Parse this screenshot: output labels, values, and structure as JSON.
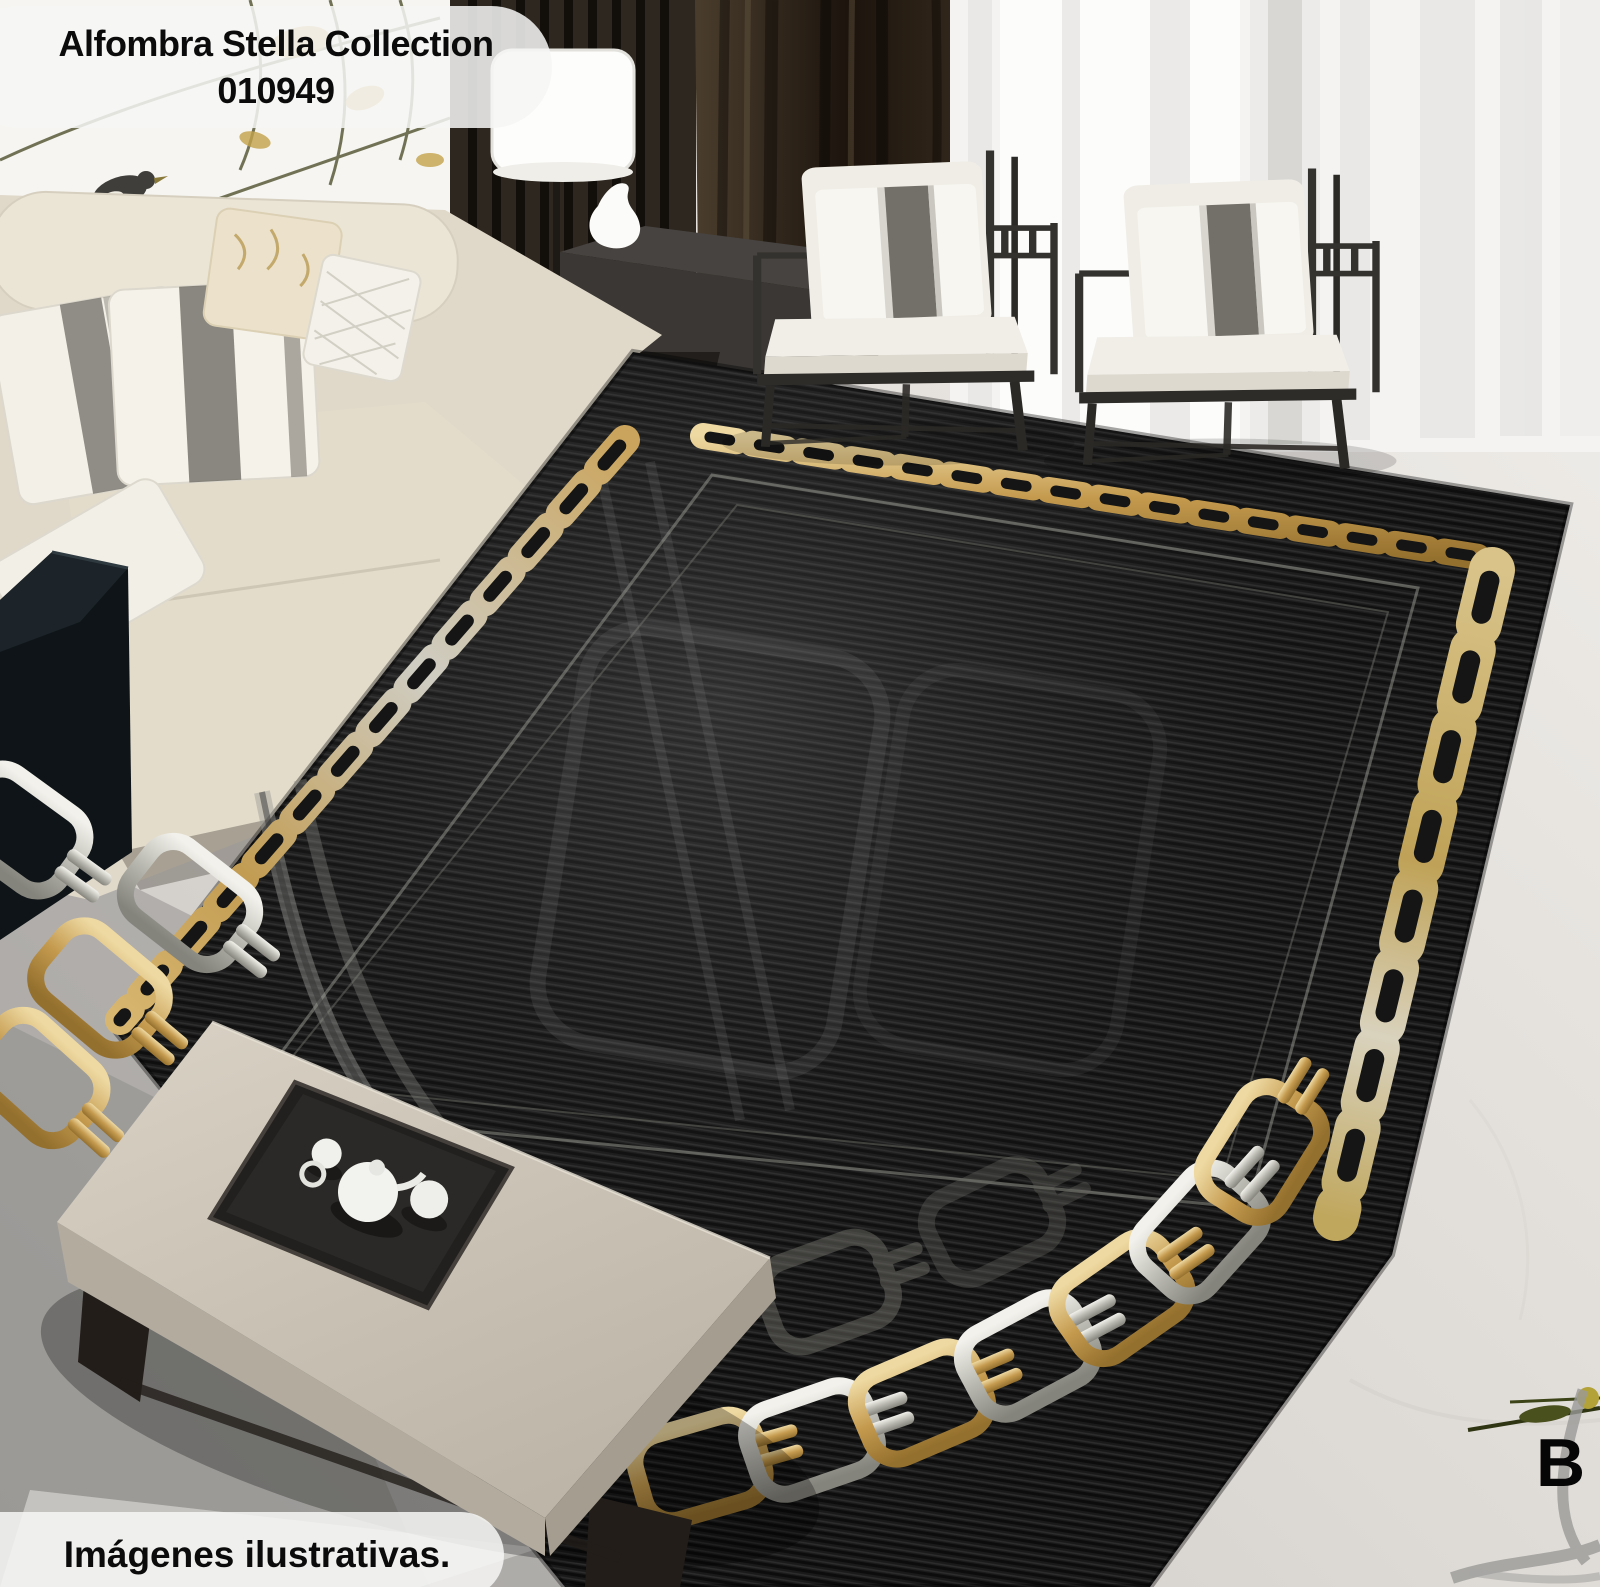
{
  "overlays": {
    "product_label_line1": "Alfombra Stella Collection",
    "product_label_line2": "010949",
    "disclaimer": "Imágenes ilustrativas.",
    "watermark_letter": "B"
  },
  "palette": {
    "rug_black": "#171717",
    "chain_gold": "#c79e52",
    "chain_silver": "#c6c5bd",
    "sofa_cream": "#e7e0d1",
    "ottoman_taupe": "#cdc5b7",
    "curtain_brown": "#241b12",
    "floor_marble": "#dedbd7",
    "frame_dark": "#393733"
  }
}
